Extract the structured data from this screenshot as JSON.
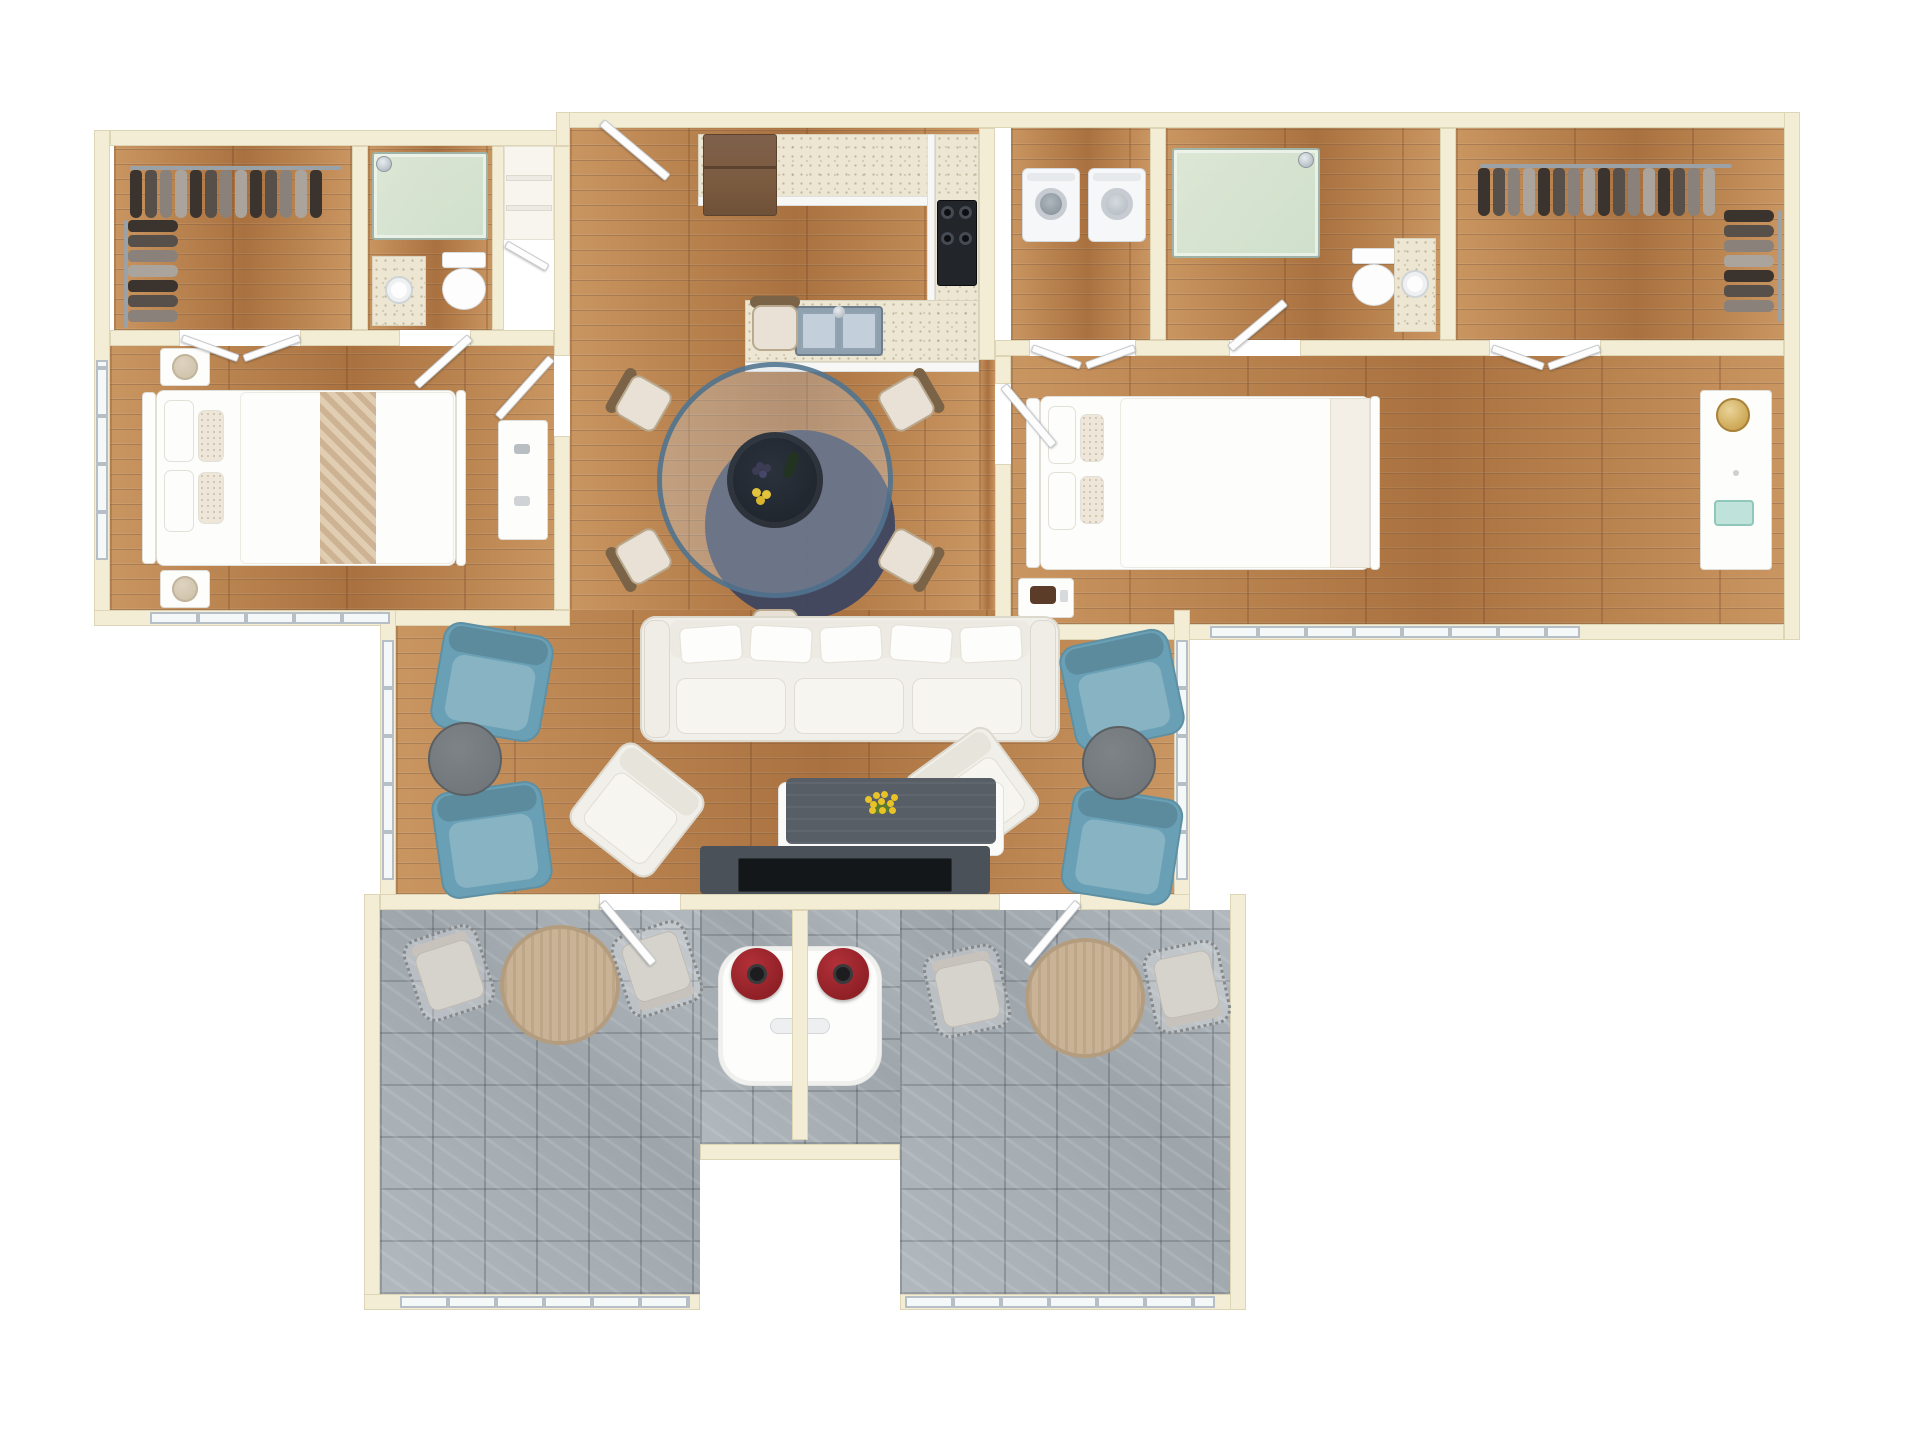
{
  "meta": {
    "description": "3D rendered top-down floor plan of a two-bedroom, two-bathroom apartment with open kitchen/dining/living area and two patios",
    "view": "top-down-render",
    "canvas": {
      "width": 1920,
      "height": 1440
    },
    "background": "#ffffff",
    "visible_text": ""
  },
  "colors": {
    "wall": "#f3edd5",
    "wall_edge": "#ddd5b6",
    "wood": "#bc8352",
    "wood_hi": "#c99560",
    "wood_lo": "#a9713f",
    "tile": "#9ea6ac",
    "tile_hi": "#b2b9be",
    "counter": "#ece6d3",
    "cabinet": "#f2f3f5",
    "fridge": "#7b5b40",
    "fridge_dark": "#5c432f",
    "stove": "#22262b",
    "sink_steel": "#8fa0af",
    "shower_glass": "#cfe0cb",
    "chrome": "#b9c2c9",
    "door": "#fdfdfd",
    "door_edge": "#c6cacd",
    "window_frame": "#b7bfc6",
    "window_glass": "#f4f8f9",
    "sofa": "#f1efe9",
    "sofa_edge": "#dcd8ce",
    "cushion": "#f7f5f0",
    "blue": "#6aa0b5",
    "side_table": "#71777b",
    "side_table_rim": "#5a6064",
    "chair_cream": "#e9e1d5",
    "chair_wood": "#7a6347",
    "glass_rim": "#4a6e8c",
    "center_dark": "#20262e",
    "rug": "#3d4660",
    "coffee_top": "#575e66",
    "coffee_base": "#fafaf8",
    "tv": "#14171a",
    "tv_console": "#4a5158",
    "flower": "#e8c227",
    "flower_green": "#5a7a2e",
    "throw": "#cdb394",
    "throw_hi": "#e0cdb2",
    "lamp_beige": "#cfc3ab",
    "gold": "#c9a14b",
    "red_lamp": "#8f2026",
    "red_lamp_hi": "#b23038",
    "patio_table": "#c9b296",
    "patio_table_rim": "#b49d7f",
    "wicker": "#d6d2cc",
    "wicker_frame": "#85898c",
    "garment_palette": [
      "#3a332e",
      "#57504a",
      "#8a827a",
      "#aaa49c"
    ]
  },
  "rooms": [
    {
      "id": "walk-in-closet-left",
      "floor": "wood"
    },
    {
      "id": "bathroom-left",
      "floor": "wood"
    },
    {
      "id": "bedroom-left",
      "floor": "wood"
    },
    {
      "id": "entry-niche",
      "floor": "white"
    },
    {
      "id": "kitchen",
      "floor": "wood"
    },
    {
      "id": "dining-area",
      "floor": "wood"
    },
    {
      "id": "living-room",
      "floor": "wood"
    },
    {
      "id": "laundry-closet",
      "floor": "wood"
    },
    {
      "id": "bathroom-right",
      "floor": "wood"
    },
    {
      "id": "walk-in-closet-right",
      "floor": "wood"
    },
    {
      "id": "bedroom-right",
      "floor": "wood"
    },
    {
      "id": "patio-left",
      "floor": "tile"
    },
    {
      "id": "entry-alcove",
      "floor": "tile"
    },
    {
      "id": "patio-right",
      "floor": "tile"
    }
  ],
  "furniture_inventory": {
    "beds": 2,
    "nightstands": 3,
    "table_lamps_beige": 3,
    "table_lamp_gold": 1,
    "dressers": 2,
    "walk_in_clothes_rails": 4,
    "showers": 2,
    "toilets": 2,
    "vanity_sinks": 2,
    "washer": 1,
    "dryer": 1,
    "refrigerator": 1,
    "range": 1,
    "double_sink": 1,
    "dining_table_round_glass": 1,
    "dining_chairs": 6,
    "centerpiece_dark": 1,
    "navy_round_rug": 1,
    "sofa": 1,
    "white_armchairs": 2,
    "blue_accent_chairs": 4,
    "round_side_tables": 2,
    "coffee_table_with_yellow_flowers": 1,
    "tv_console": 1,
    "patio_round_tables": 2,
    "wicker_patio_chairs": 4,
    "red_table_lamps": 2,
    "entry_console_table": 1
  }
}
